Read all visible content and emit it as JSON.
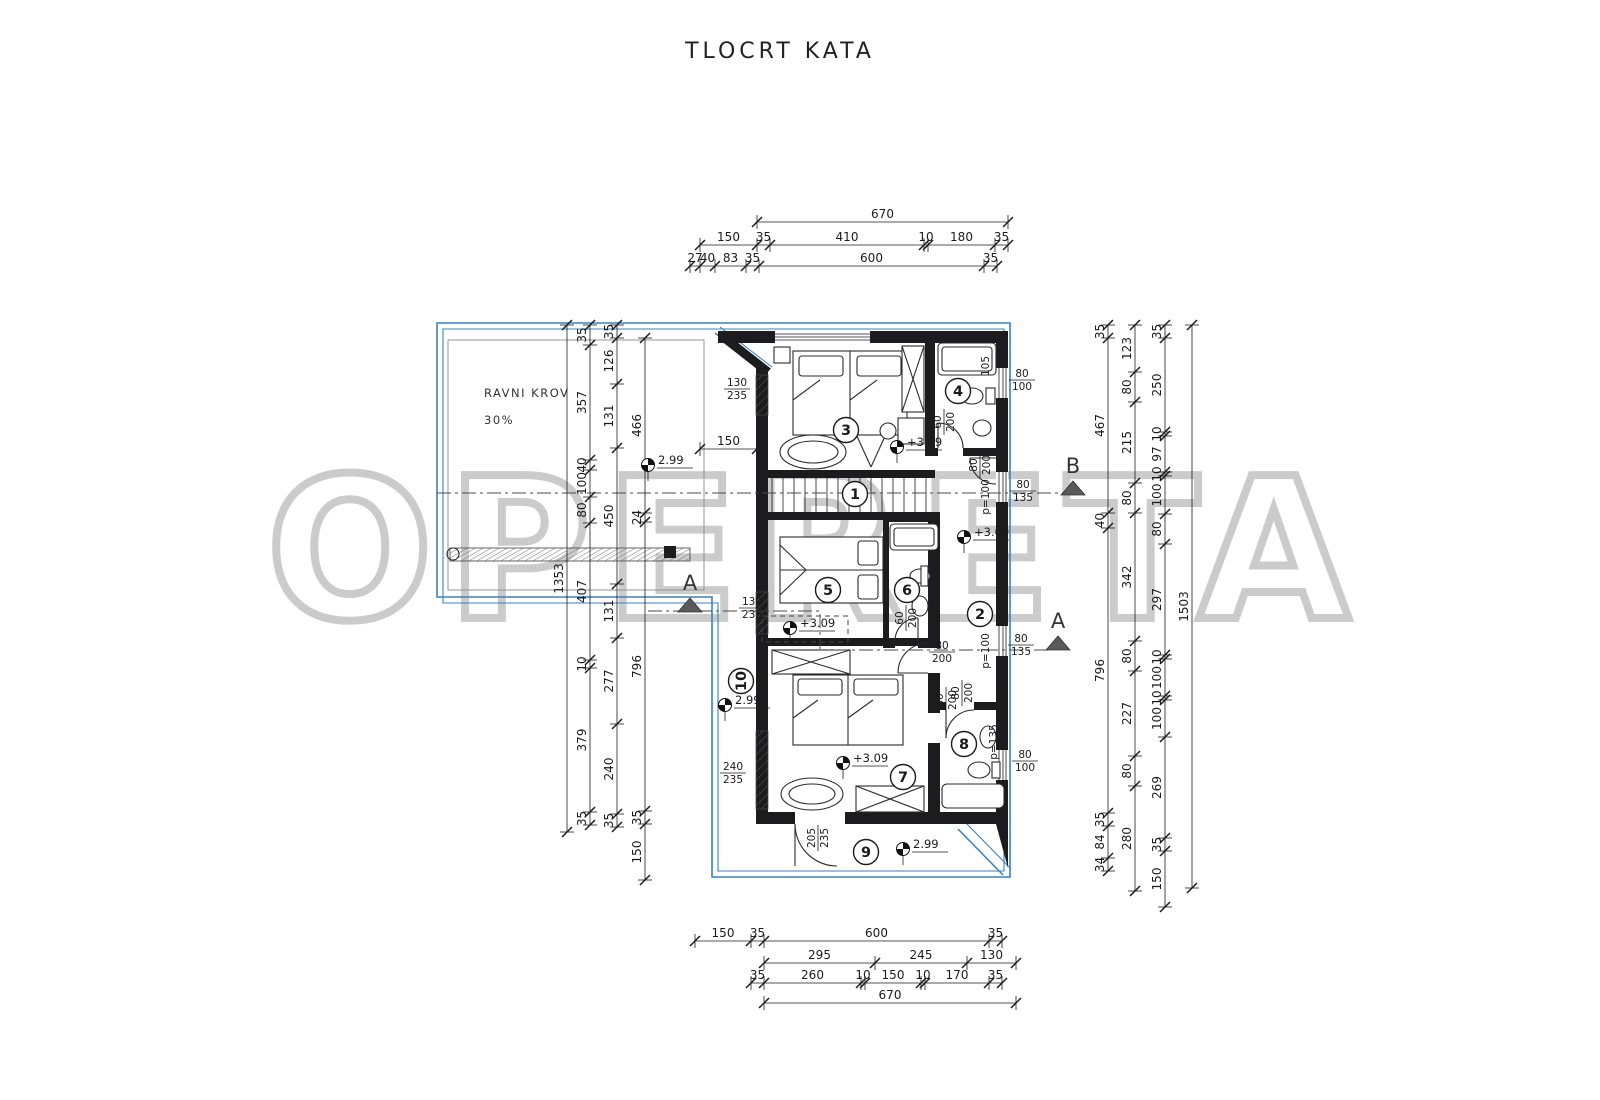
{
  "title": "TLOCRT KATA",
  "watermark": "OPERETA",
  "roof": {
    "line1": "RAVNI KROV",
    "line2": "30%"
  },
  "colors": {
    "line": "#1b1b1b",
    "blue": "#3c80c2",
    "watermark": "#c9c9c9"
  },
  "drawing": {
    "rooms": [
      {
        "n": "1",
        "x": 855,
        "y": 494,
        "rot": 0
      },
      {
        "n": "2",
        "x": 980,
        "y": 614,
        "rot": 0
      },
      {
        "n": "3",
        "x": 846,
        "y": 430,
        "rot": 0
      },
      {
        "n": "4",
        "x": 958,
        "y": 391,
        "rot": 0
      },
      {
        "n": "5",
        "x": 828,
        "y": 590,
        "rot": 0
      },
      {
        "n": "6",
        "x": 907,
        "y": 590,
        "rot": 0
      },
      {
        "n": "7",
        "x": 903,
        "y": 777,
        "rot": 0
      },
      {
        "n": "8",
        "x": 964,
        "y": 744,
        "rot": 0
      },
      {
        "n": "9",
        "x": 866,
        "y": 852,
        "rot": 0
      },
      {
        "n": "10",
        "x": 741,
        "y": 681,
        "rot": -90
      }
    ],
    "levels": [
      {
        "text": "2.99",
        "x": 648,
        "y": 465
      },
      {
        "text": "2.99",
        "x": 725,
        "y": 705
      },
      {
        "text": "2.99",
        "x": 903,
        "y": 849
      },
      {
        "text": "+3.09",
        "x": 897,
        "y": 447
      },
      {
        "text": "+3.09",
        "x": 964,
        "y": 537
      },
      {
        "text": "+3.09",
        "x": 790,
        "y": 628
      },
      {
        "text": "+3.09",
        "x": 843,
        "y": 763
      }
    ],
    "fractions": [
      {
        "top": "130",
        "bot": "235",
        "x": 737,
        "y": 389,
        "rot": 0
      },
      {
        "top": "130",
        "bot": "235",
        "x": 752,
        "y": 608,
        "rot": 0
      },
      {
        "top": "240",
        "bot": "235",
        "x": 733,
        "y": 773,
        "rot": 0
      },
      {
        "top": "205",
        "bot": "235",
        "x": 818,
        "y": 838,
        "rot": -90
      },
      {
        "top": "80",
        "bot": "100",
        "x": 1022,
        "y": 380,
        "rot": 0
      },
      {
        "top": "80",
        "bot": "135",
        "x": 1023,
        "y": 491,
        "rot": 0
      },
      {
        "top": "80",
        "bot": "135",
        "x": 1021,
        "y": 645,
        "rot": 0
      },
      {
        "top": "80",
        "bot": "100",
        "x": 1025,
        "y": 761,
        "rot": 0
      },
      {
        "top": "60",
        "bot": "200",
        "x": 944,
        "y": 422,
        "rot": -90
      },
      {
        "top": "60",
        "bot": "200",
        "x": 906,
        "y": 618,
        "rot": -90
      },
      {
        "top": "60",
        "bot": "200",
        "x": 946,
        "y": 700,
        "rot": -90
      },
      {
        "top": "80",
        "bot": "200",
        "x": 980,
        "y": 465,
        "rot": -90
      },
      {
        "top": "80",
        "bot": "200",
        "x": 942,
        "y": 652,
        "rot": 0
      },
      {
        "top": "80",
        "bot": "200",
        "x": 962,
        "y": 693,
        "rot": -90
      }
    ],
    "small_labels": [
      {
        "text": "p=100",
        "x": 989,
        "y": 497,
        "rot": -90
      },
      {
        "text": "p=100",
        "x": 989,
        "y": 651,
        "rot": -90
      },
      {
        "text": "p=135",
        "x": 997,
        "y": 742,
        "rot": -90
      },
      {
        "text": "105",
        "x": 989,
        "y": 366,
        "rot": -90
      }
    ],
    "sections": [
      {
        "label": "B",
        "x": 1073,
        "y": 473
      },
      {
        "label": "A",
        "x": 690,
        "y": 590
      },
      {
        "label": "A",
        "x": 1058,
        "y": 628
      }
    ],
    "hdims": [
      {
        "y": 222,
        "segs": [
          {
            "x1": 757,
            "x2": 1008,
            "label": "670"
          }
        ]
      },
      {
        "y": 245,
        "segs": [
          {
            "x1": 700,
            "x2": 757,
            "label": "150"
          },
          {
            "x1": 757,
            "x2": 770,
            "label": "35"
          },
          {
            "x1": 770,
            "x2": 924,
            "label": "410"
          },
          {
            "x1": 924,
            "x2": 928,
            "label": "10"
          },
          {
            "x1": 928,
            "x2": 995,
            "label": "180"
          },
          {
            "x1": 995,
            "x2": 1008,
            "label": "35"
          }
        ]
      },
      {
        "y": 266,
        "segs": [
          {
            "x1": 690,
            "x2": 700,
            "label": "27"
          },
          {
            "x1": 700,
            "x2": 715,
            "label": "40"
          },
          {
            "x1": 715,
            "x2": 746,
            "label": "83"
          },
          {
            "x1": 746,
            "x2": 759,
            "label": "35"
          },
          {
            "x1": 759,
            "x2": 984,
            "label": "600"
          },
          {
            "x1": 984,
            "x2": 997,
            "label": "35"
          }
        ]
      },
      {
        "y": 449,
        "segs": [
          {
            "x1": 700,
            "x2": 757,
            "label": "150"
          }
        ]
      },
      {
        "y": 941,
        "segs": [
          {
            "x1": 695,
            "x2": 751,
            "label": "150"
          },
          {
            "x1": 751,
            "x2": 764,
            "label": "35"
          },
          {
            "x1": 764,
            "x2": 989,
            "label": "600"
          },
          {
            "x1": 989,
            "x2": 1002,
            "label": "35"
          }
        ]
      },
      {
        "y": 963,
        "segs": [
          {
            "x1": 764,
            "x2": 875,
            "label": "295"
          },
          {
            "x1": 875,
            "x2": 967,
            "label": "245"
          },
          {
            "x1": 967,
            "x2": 1016,
            "label": "130"
          }
        ]
      },
      {
        "y": 983,
        "segs": [
          {
            "x1": 751,
            "x2": 764,
            "label": "35"
          },
          {
            "x1": 764,
            "x2": 861,
            "label": "260"
          },
          {
            "x1": 861,
            "x2": 865,
            "label": "10"
          },
          {
            "x1": 865,
            "x2": 921,
            "label": "150"
          },
          {
            "x1": 921,
            "x2": 925,
            "label": "10"
          },
          {
            "x1": 925,
            "x2": 989,
            "label": "170"
          },
          {
            "x1": 989,
            "x2": 1002,
            "label": "35"
          }
        ]
      },
      {
        "y": 1003,
        "segs": [
          {
            "x1": 764,
            "x2": 1016,
            "label": "670"
          }
        ]
      }
    ],
    "vdims": [
      {
        "x": 567,
        "segs": [
          {
            "y1": 325,
            "y2": 832,
            "label": "1353"
          }
        ]
      },
      {
        "x": 590,
        "segs": [
          {
            "y1": 325,
            "y2": 345,
            "label": "35"
          },
          {
            "y1": 345,
            "y2": 460,
            "label": "357"
          },
          {
            "y1": 460,
            "y2": 470,
            "label": "40"
          },
          {
            "y1": 470,
            "y2": 497,
            "label": "100"
          },
          {
            "y1": 497,
            "y2": 523,
            "label": "80"
          },
          {
            "y1": 523,
            "y2": 660,
            "label": "407"
          },
          {
            "y1": 660,
            "y2": 668,
            "label": "10"
          },
          {
            "y1": 668,
            "y2": 812,
            "label": "379"
          },
          {
            "y1": 812,
            "y2": 825,
            "label": "35"
          }
        ]
      },
      {
        "x": 617,
        "segs": [
          {
            "y1": 325,
            "y2": 338,
            "label": "35"
          },
          {
            "y1": 338,
            "y2": 384,
            "label": "126"
          },
          {
            "y1": 384,
            "y2": 448,
            "label": "131"
          },
          {
            "y1": 448,
            "y2": 584,
            "label": "450"
          },
          {
            "y1": 584,
            "y2": 638,
            "label": "131"
          },
          {
            "y1": 638,
            "y2": 724,
            "label": "277"
          },
          {
            "y1": 724,
            "y2": 814,
            "label": "240"
          },
          {
            "y1": 814,
            "y2": 827,
            "label": "35"
          }
        ]
      },
      {
        "x": 645,
        "segs": [
          {
            "y1": 338,
            "y2": 513,
            "label": "466"
          },
          {
            "y1": 513,
            "y2": 522,
            "label": "24"
          },
          {
            "y1": 522,
            "y2": 811,
            "label": "796"
          },
          {
            "y1": 811,
            "y2": 824,
            "label": "35"
          },
          {
            "y1": 824,
            "y2": 880,
            "label": "150"
          }
        ]
      },
      {
        "x": 1108,
        "segs": [
          {
            "y1": 325,
            "y2": 338,
            "label": "35"
          },
          {
            "y1": 338,
            "y2": 513,
            "label": "467"
          },
          {
            "y1": 513,
            "y2": 528,
            "label": "40"
          },
          {
            "y1": 528,
            "y2": 813,
            "label": "796"
          },
          {
            "y1": 813,
            "y2": 826,
            "label": "35"
          },
          {
            "y1": 826,
            "y2": 858,
            "label": "84"
          },
          {
            "y1": 858,
            "y2": 871,
            "label": "34"
          }
        ]
      },
      {
        "x": 1135,
        "segs": [
          {
            "y1": 325,
            "y2": 372,
            "label": "123"
          },
          {
            "y1": 372,
            "y2": 402,
            "label": "80"
          },
          {
            "y1": 402,
            "y2": 483,
            "label": "215"
          },
          {
            "y1": 483,
            "y2": 513,
            "label": "80"
          },
          {
            "y1": 513,
            "y2": 641,
            "label": "342"
          },
          {
            "y1": 641,
            "y2": 671,
            "label": "80"
          },
          {
            "y1": 671,
            "y2": 756,
            "label": "227"
          },
          {
            "y1": 756,
            "y2": 786,
            "label": "80"
          },
          {
            "y1": 786,
            "y2": 891,
            "label": "280"
          }
        ]
      },
      {
        "x": 1165,
        "segs": [
          {
            "y1": 325,
            "y2": 338,
            "label": "35"
          },
          {
            "y1": 338,
            "y2": 432,
            "label": "250"
          },
          {
            "y1": 432,
            "y2": 436,
            "label": "10"
          },
          {
            "y1": 436,
            "y2": 472,
            "label": "97"
          },
          {
            "y1": 472,
            "y2": 476,
            "label": "10"
          },
          {
            "y1": 476,
            "y2": 514,
            "label": "100"
          },
          {
            "y1": 514,
            "y2": 544,
            "label": "80"
          },
          {
            "y1": 544,
            "y2": 655,
            "label": "297"
          },
          {
            "y1": 655,
            "y2": 659,
            "label": "10"
          },
          {
            "y1": 659,
            "y2": 696,
            "label": "100"
          },
          {
            "y1": 696,
            "y2": 700,
            "label": "10"
          },
          {
            "y1": 700,
            "y2": 737,
            "label": "100"
          },
          {
            "y1": 737,
            "y2": 838,
            "label": "269"
          },
          {
            "y1": 838,
            "y2": 851,
            "label": "35"
          },
          {
            "y1": 851,
            "y2": 907,
            "label": "150"
          }
        ]
      },
      {
        "x": 1192,
        "segs": [
          {
            "y1": 325,
            "y2": 888,
            "label": "1503"
          }
        ]
      }
    ]
  }
}
